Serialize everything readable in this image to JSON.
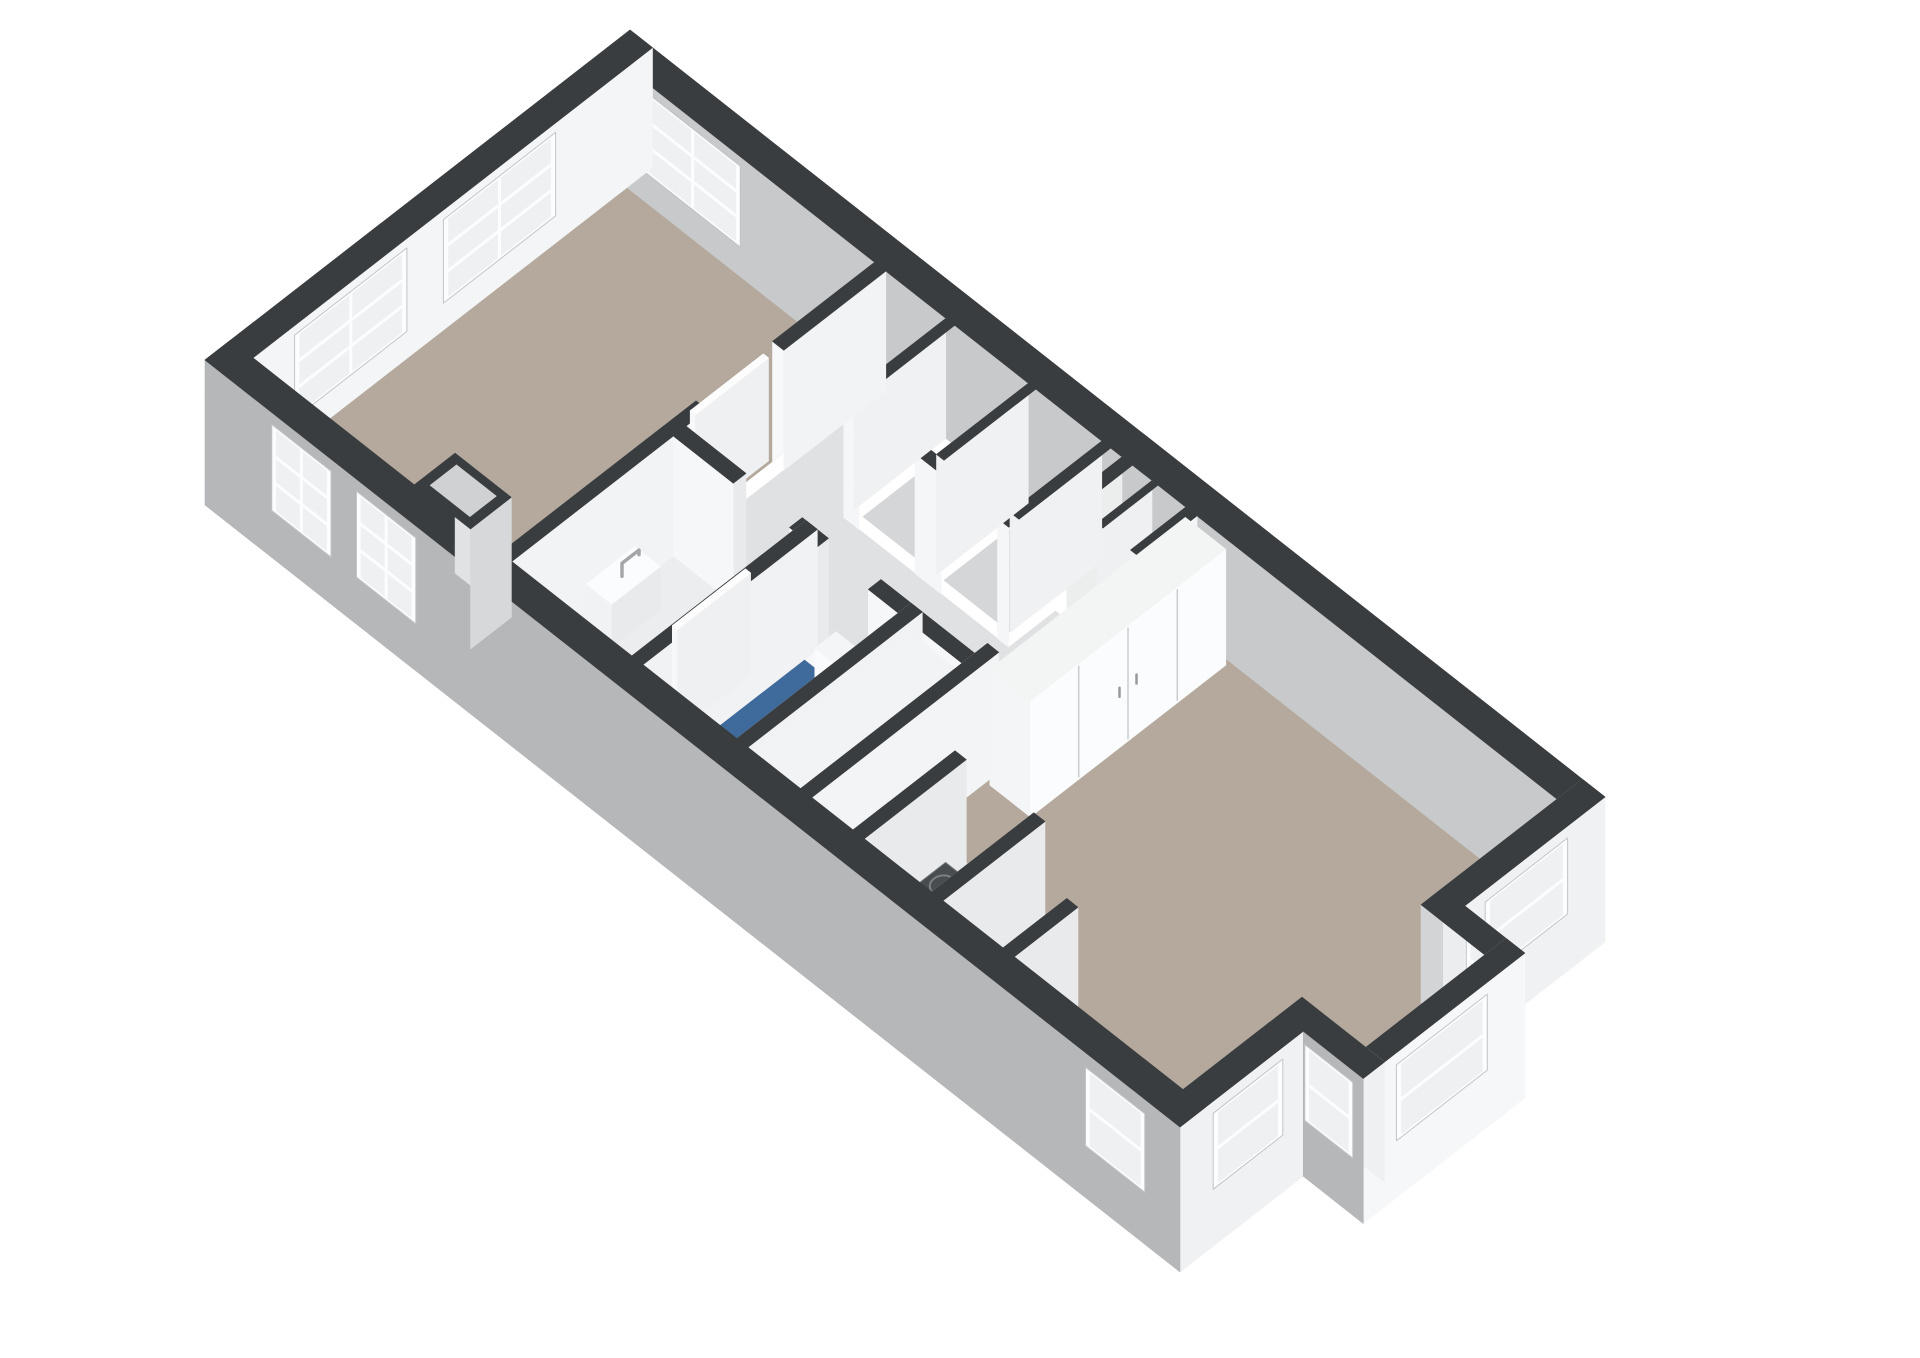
{
  "scene": {
    "type": "3d-floorplan-render",
    "background": "#ffffff",
    "canvas": {
      "width": 1920,
      "height": 1358
    }
  },
  "palette": {
    "wall_top": "#3a3d3f",
    "wall_exterior_sw": "#b5b7b9",
    "wall_exterior_light": "#f0f1f2",
    "wall_interior_white": "#f4f5f6",
    "wall_interior_shadow": "#c7c9cb",
    "floor_wood": "#b4a99c",
    "floor_hall": "#e0e1e3",
    "floor_bath": "#ebedee",
    "floor_toilet_blue": "#3e6a9c",
    "window_frame": "#fcfdfe",
    "window_glass": "#eef0f2",
    "front_door_brown": "#7a3e22",
    "appliance_dark": "#1d1e1f",
    "hob_dark": "#4a4d4f"
  },
  "projection": {
    "origin": [
      205,
      480
    ],
    "u": [
      75,
      59
    ],
    "v": [
      85,
      -66
    ],
    "hz": 50,
    "wall_h": 2.4,
    "frame_margin": 0.06
  },
  "items": [
    {
      "kind": "floor",
      "name": "bedroom-floor",
      "u": [
        0.3,
        3.6
      ],
      "v": [
        0.3,
        4.7
      ],
      "fill": "#b4a99c"
    },
    {
      "kind": "floor",
      "name": "hallway-floor",
      "u": [
        3.75,
        7.75
      ],
      "v": [
        2.35,
        3.5
      ],
      "fill": "#e0e1e3"
    },
    {
      "kind": "floor",
      "name": "hallway-floor-west",
      "u": [
        3.75,
        4.55
      ],
      "v": [
        3.5,
        4.7
      ],
      "fill": "#e0e1e3"
    },
    {
      "kind": "floor",
      "name": "hallway-floor-east",
      "u": [
        6.75,
        7.75
      ],
      "v": [
        3.5,
        4.05
      ],
      "fill": "#e0e1e3"
    },
    {
      "kind": "floor",
      "name": "bathroom-floor",
      "u": [
        3.75,
        5.35
      ],
      "v": [
        0.3,
        2.2
      ],
      "fill": "#ebedee"
    },
    {
      "kind": "floor",
      "name": "toilet-floor",
      "u": [
        5.5,
        6.75
      ],
      "v": [
        0.3,
        2.2
      ],
      "fill": "#3e6a9c"
    },
    {
      "kind": "floor",
      "name": "closet-1-floor",
      "u": [
        4.67,
        5.65
      ],
      "v": [
        3.62,
        4.7
      ],
      "fill": "#d4d6d8"
    },
    {
      "kind": "floor",
      "name": "closet-2-floor",
      "u": [
        5.75,
        6.63
      ],
      "v": [
        3.62,
        4.7
      ],
      "fill": "#d4d6d8"
    },
    {
      "kind": "floor",
      "name": "entry-niche-left-floor",
      "u": [
        6.95,
        7.3
      ],
      "v": [
        4.2,
        4.7
      ],
      "fill": "#dcdee0"
    },
    {
      "kind": "floor",
      "name": "entry-niche-right-floor",
      "u": [
        7.38,
        7.7
      ],
      "v": [
        4.2,
        4.7
      ],
      "fill": "#dcdee0"
    },
    {
      "kind": "floor",
      "name": "living-floor",
      "u": [
        7.75,
        12.7
      ],
      "v": [
        0.3,
        4.7
      ],
      "fill": "#b4a99c"
    },
    {
      "kind": "floor",
      "name": "bay-floor",
      "u": [
        12.7,
        13.55
      ],
      "v": [
        1.7,
        3.1
      ],
      "fill": "#b4a99c"
    },
    {
      "kind": "wall",
      "name": "wall-ne",
      "dir": "u",
      "at": 4.7,
      "t": 0.3,
      "from": 0,
      "to": 13,
      "faces": [
        {
          "side": "near",
          "fill": "#c7c9cb",
          "windows": [
            {
              "a": 0.6,
              "b": 1.75,
              "h1": 0.65,
              "h2": 2.15,
              "cols": 2,
              "rows": 3
            }
          ]
        }
      ]
    },
    {
      "kind": "wall",
      "name": "wall-nw-end",
      "dir": "v",
      "at": 0,
      "t": 0.3,
      "from": 0,
      "to": 5,
      "faces": [
        {
          "side": "near",
          "fill": "#eef0f1"
        },
        {
          "side": "far",
          "fill": "#f4f5f6",
          "windows": [
            {
              "a": 0.85,
              "b": 2.05,
              "h1": 0.6,
              "h2": 2.15,
              "cols": 2,
              "rows": 3
            },
            {
              "a": 2.6,
              "b": 3.8,
              "h1": 0.6,
              "h2": 2.15,
              "cols": 2,
              "rows": 3
            }
          ]
        }
      ]
    },
    {
      "kind": "wall",
      "name": "wall-entry-niche-back",
      "dir": "u",
      "at": 4.05,
      "t": 0.15,
      "from": 6.9,
      "to": 7.75,
      "faces": [
        {
          "side": "far",
          "fill": "#f4f5f6",
          "rects": [
            {
              "a": 7.4,
              "b": 7.68,
              "h1": 0.02,
              "h2": 2.1,
              "fill": "#7a3e22"
            }
          ]
        },
        {
          "side": "near",
          "fill": "#f0f1f2"
        }
      ]
    },
    {
      "kind": "wall",
      "name": "wall-entry-step-a",
      "dir": "v",
      "at": 6.9,
      "t": 0.14,
      "from": 4.05,
      "to": 4.7,
      "faces": [
        {
          "side": "near",
          "fill": "#eceded"
        }
      ]
    },
    {
      "kind": "wall",
      "name": "wall-entry-divider",
      "dir": "v",
      "at": 7.3,
      "t": 0.08,
      "from": 4.05,
      "to": 4.7,
      "faces": [
        {
          "side": "near",
          "fill": "#eef0f1"
        }
      ]
    },
    {
      "kind": "wall",
      "name": "wall-entry-step-b",
      "dir": "v",
      "at": 7.75,
      "t": 0.15,
      "from": 4.05,
      "to": 4.7,
      "faces": [
        {
          "side": "near",
          "fill": "#f2f3f4"
        },
        {
          "side": "far",
          "fill": "#f5f6f7"
        }
      ]
    },
    {
      "kind": "wall",
      "name": "wall-se-upper",
      "dir": "v",
      "at": 12.7,
      "t": 0.3,
      "from": 3.1,
      "to": 5,
      "faces": [
        {
          "side": "near",
          "fill": "#d2d4d6"
        },
        {
          "side": "far",
          "fill": "#f0f1f2",
          "slab": 0.5,
          "windows": [
            {
              "a": 3.65,
              "b": 4.5,
              "h1": 0.7,
              "h2": 2.1,
              "cols": 1,
              "rows": 2
            }
          ]
        }
      ]
    },
    {
      "kind": "wall",
      "name": "wall-se-lower",
      "dir": "v",
      "at": 12.7,
      "t": 0.3,
      "from": 0,
      "to": 1.7,
      "faces": [
        {
          "side": "near",
          "fill": "#d2d4d6"
        },
        {
          "side": "far",
          "fill": "#f0f1f2",
          "slab": 0.5,
          "windows": [
            {
              "a": 0.45,
              "b": 1.15,
              "h1": 0.7,
              "h2": 2.1,
              "cols": 1,
              "rows": 2
            }
          ]
        }
      ]
    },
    {
      "kind": "wall",
      "name": "wall-closets-front",
      "dir": "u",
      "at": 3.5,
      "t": 0.12,
      "from": 4.55,
      "to": 6.75,
      "openings": [
        [
          4.75,
          5.5
        ],
        [
          5.85,
          6.6
        ]
      ],
      "faces": [
        {
          "side": "near",
          "fill": "#f5f6f7"
        }
      ]
    },
    {
      "kind": "wall",
      "name": "wall-closets-end-left",
      "dir": "v",
      "at": 4.55,
      "t": 0.12,
      "from": 3.62,
      "to": 4.7,
      "faces": [
        {
          "side": "near",
          "fill": "#f0f1f2"
        }
      ]
    },
    {
      "kind": "wall",
      "name": "wall-closets-end-right",
      "dir": "v",
      "at": 6.63,
      "t": 0.12,
      "from": 3.62,
      "to": 4.7,
      "faces": [
        {
          "side": "near",
          "fill": "#f0f1f2"
        }
      ]
    },
    {
      "kind": "wall",
      "name": "wall-closets-divider",
      "dir": "v",
      "at": 5.65,
      "t": 0.1,
      "from": 3.62,
      "to": 4.7,
      "faces": [
        {
          "side": "near",
          "fill": "#f0f1f2"
        }
      ]
    },
    {
      "kind": "wall",
      "name": "wall-bedroom-divider",
      "dir": "v",
      "at": 3.6,
      "t": 0.15,
      "from": 0.3,
      "to": 4.7,
      "openings": [
        [
          2.6,
          3.5
        ]
      ],
      "faces": [
        {
          "side": "near",
          "fill": "#f7f8f9"
        },
        {
          "side": "far",
          "fill": "#f2f3f4"
        }
      ]
    },
    {
      "kind": "box",
      "name": "bedroom-door-leaf",
      "u": [
        3.5,
        3.57
      ],
      "v": [
        2.62,
        3.48
      ],
      "h": 2.06,
      "top": "#fdfdfe",
      "sw": "#f7f8f9",
      "se": "#eff0f2"
    },
    {
      "kind": "box",
      "name": "hand-basin",
      "u": [
        3.78,
        4.12
      ],
      "v": [
        1.15,
        1.72
      ],
      "h": 0.86,
      "top": "#fbfcfd",
      "sw": "#f1f2f3",
      "se": "#e9eaeb"
    },
    {
      "kind": "faucet",
      "name": "basin-faucet",
      "pts": [
        [
          3.95,
          1.42,
          0.86
        ],
        [
          3.95,
          1.42,
          1.12
        ],
        [
          3.95,
          1.62,
          1.12
        ],
        [
          3.95,
          1.62,
          1.03
        ]
      ]
    },
    {
      "kind": "wall",
      "name": "wall-hall-south",
      "dir": "u",
      "at": 2.2,
      "t": 0.15,
      "from": 3.75,
      "to": 7.6,
      "openings": [
        [
          4.55,
          5.3
        ],
        [
          5.65,
          6.35
        ]
      ],
      "faces": [
        {
          "side": "far",
          "fill": "#e9eaeb"
        },
        {
          "side": "near",
          "fill": "#f6f7f8"
        }
      ]
    },
    {
      "kind": "wall",
      "name": "wall-bath-toilet",
      "dir": "v",
      "at": 5.35,
      "t": 0.15,
      "from": 0.3,
      "to": 2.35,
      "faces": [
        {
          "side": "near",
          "fill": "#f6f7f8"
        },
        {
          "side": "far",
          "fill": "#f1f2f3"
        }
      ]
    },
    {
      "kind": "box",
      "name": "bathroom-door-leaf",
      "u": [
        5.21,
        5.28
      ],
      "v": [
        0.9,
        1.76
      ],
      "h": 2.05,
      "top": "#fdfdfe",
      "sw": "#f7f8f9",
      "se": "#eff0f2"
    },
    {
      "kind": "box",
      "name": "toilet-cistern",
      "u": [
        5.92,
        6.42
      ],
      "v": [
        1.95,
        2.2
      ],
      "h": 1.05,
      "top": "#f4f5f6",
      "sw": "#fafbfc",
      "se": "#eef0f1"
    },
    {
      "kind": "bowl",
      "name": "toilet-bowl",
      "cu": 6.17,
      "cv": 1.6,
      "ru": 0.25,
      "rv": 0.34,
      "h": 0.44,
      "fill": "#fafbfc",
      "stroke": "#d5d7d9"
    },
    {
      "kind": "wall",
      "name": "wall-toilet-kitchen",
      "dir": "v",
      "at": 6.75,
      "t": 0.15,
      "from": 0.3,
      "to": 2.35,
      "faces": [
        {
          "side": "near",
          "fill": "#f6f7f8"
        },
        {
          "side": "far",
          "fill": "#f1f2f3"
        }
      ]
    },
    {
      "kind": "box",
      "name": "kitchen-cabinets",
      "u": [
        6.9,
        7.6
      ],
      "v": [
        0.35,
        2.2
      ],
      "h": 2.2,
      "top": "#f2f3f4",
      "sw": "#f7f8f9",
      "se": "#fdfdfe",
      "se_seams": [
        0.95,
        1.62,
        1.9
      ],
      "se_rects": [
        {
          "a": 0.98,
          "b": 1.58,
          "h1": 0.6,
          "h2": 1.5,
          "fill": "#1d1e1f"
        }
      ],
      "se_handles": [
        {
          "v": 1.74,
          "h1": 1.08,
          "h2": 1.32
        }
      ]
    },
    {
      "kind": "wall",
      "name": "wall-living-nw",
      "dir": "v",
      "at": 7.6,
      "t": 0.15,
      "from": 0.3,
      "to": 2.5,
      "faces": [
        {
          "side": "near",
          "fill": "#eceded"
        },
        {
          "side": "far",
          "fill": "#f3f4f5"
        }
      ]
    },
    {
      "kind": "box",
      "name": "living-closet",
      "u": [
        7.8,
        8.34
      ],
      "v": [
        2.35,
        4.65
      ],
      "h": 2.32,
      "top": "#f3f4f4",
      "sw": "#f4f5f6",
      "se": "#fbfcfd",
      "se_seams": [
        2.92,
        3.5,
        4.08
      ],
      "se_handles": [
        {
          "v": 3.4,
          "h1": 1.02,
          "h2": 1.2
        },
        {
          "v": 3.6,
          "h1": 1.02,
          "h2": 1.2
        }
      ]
    },
    {
      "kind": "wall",
      "name": "kitchen-nook-wall-a",
      "dir": "v",
      "at": 8.3,
      "t": 0.15,
      "from": 0.3,
      "to": 1.5,
      "faces": [
        {
          "side": "near",
          "fill": "#f1f2f3"
        },
        {
          "side": "far",
          "fill": "#e9eaeb"
        }
      ]
    },
    {
      "kind": "box",
      "name": "cooker-counter",
      "u": [
        8.45,
        9.35
      ],
      "v": [
        0.3,
        1.28
      ],
      "h": 0.92,
      "top": "#e9eaec",
      "sw": "#eff0f1",
      "se": "#f5f6f7"
    },
    {
      "kind": "hob",
      "name": "gas-hob",
      "u": [
        8.56,
        9.24
      ],
      "v": [
        0.4,
        1.16
      ],
      "h": 0.92,
      "fill": "#4a4d4f",
      "line": "#6e7173",
      "burner": "#7d8082"
    },
    {
      "kind": "wall",
      "name": "kitchen-nook-wall-b",
      "dir": "v",
      "at": 9.35,
      "t": 0.15,
      "from": 0.3,
      "to": 1.5,
      "faces": [
        {
          "side": "near",
          "fill": "#f1f2f3"
        },
        {
          "side": "far",
          "fill": "#e9eaeb"
        }
      ]
    },
    {
      "kind": "wall",
      "name": "chimney-stub-wall",
      "dir": "v",
      "at": 10.3,
      "t": 0.15,
      "from": 0.3,
      "to": 1.05,
      "faces": [
        {
          "side": "near",
          "fill": "#f1f2f3"
        },
        {
          "side": "far",
          "fill": "#e9eaeb"
        }
      ]
    },
    {
      "kind": "wall",
      "name": "bay-wall-ne",
      "dir": "u",
      "at": 3.1,
      "t": 0.25,
      "from": 13,
      "to": 13.8,
      "faces": [
        {
          "side": "near",
          "fill": "#ecedee"
        },
        {
          "side": "far",
          "fill": "#f1f2f3",
          "slab": 0.5,
          "windows": [
            {
              "a": 13.08,
              "b": 13.6,
              "h1": 0.7,
              "h2": 2.1,
              "cols": 1,
              "rows": 2
            }
          ]
        }
      ]
    },
    {
      "kind": "wall",
      "name": "bay-wall-se",
      "dir": "v",
      "at": 13.55,
      "t": 0.25,
      "from": 1.45,
      "to": 3.35,
      "faces": [
        {
          "side": "near",
          "fill": "#ecedee"
        },
        {
          "side": "far",
          "fill": "#f6f7f8",
          "slab": 0.5,
          "windows": [
            {
              "a": 1.9,
              "b": 2.85,
              "h1": 0.7,
              "h2": 2.1,
              "cols": 1,
              "rows": 2
            }
          ]
        }
      ]
    },
    {
      "kind": "wall",
      "name": "bay-wall-sw",
      "dir": "u",
      "at": 1.45,
      "t": 0.25,
      "from": 13,
      "to": 13.8,
      "faces": [
        {
          "side": "far",
          "fill": "#eff0f1"
        },
        {
          "side": "near",
          "fill": "#b5b7b9",
          "slab": 0.5,
          "windows": [
            {
              "a": 13.08,
              "b": 13.6,
              "h1": 0.7,
              "h2": 2.1,
              "cols": 1,
              "rows": 2
            }
          ]
        }
      ]
    },
    {
      "kind": "wall",
      "name": "wall-sw",
      "dir": "u",
      "at": 0,
      "t": 0.3,
      "from": 0,
      "to": 13,
      "faces": [
        {
          "side": "near",
          "fill": "#b5b7b9",
          "slab": 0.5,
          "windows": [
            {
              "a": 0.95,
              "b": 1.62,
              "h1": 0.5,
              "h2": 2.1,
              "cols": 2,
              "rows": 3
            },
            {
              "a": 2.08,
              "b": 2.75,
              "h1": 0.5,
              "h2": 2.1,
              "cols": 2,
              "rows": 3
            },
            {
              "a": 11.8,
              "b": 12.47,
              "h1": 0.6,
              "h2": 2.05,
              "cols": 1,
              "rows": 2
            }
          ]
        }
      ]
    },
    {
      "kind": "chimney",
      "name": "chimney-recess",
      "u": [
        2.45,
        3.2
      ],
      "v": [
        0.3,
        0.78
      ],
      "iu": [
        2.56,
        3.09
      ],
      "iv": [
        0.39,
        0.7
      ],
      "frame": "#3a3d3f",
      "hole": "#cfd1d3",
      "face": "#e0e2e4",
      "side": "#d6d8da"
    }
  ]
}
